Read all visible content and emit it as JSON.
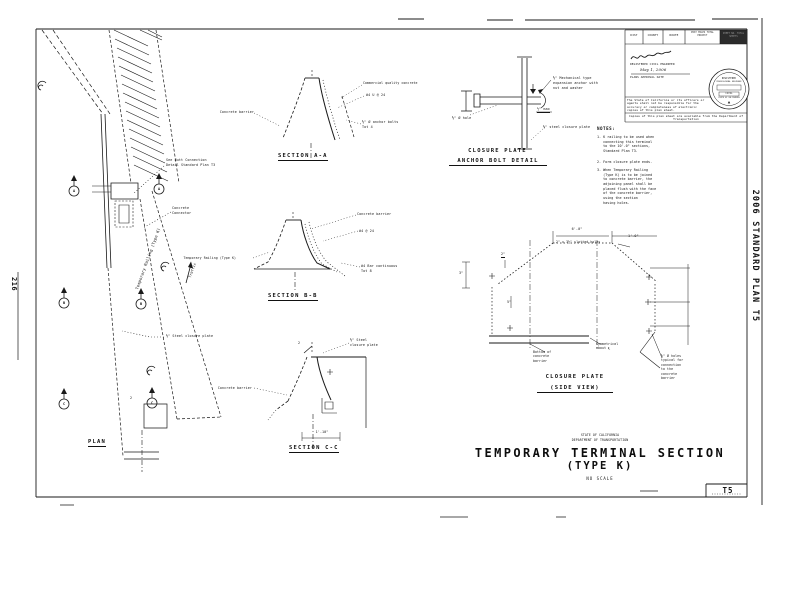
{
  "page": {
    "number": "216",
    "edge": "2006 STANDARD PLAN T5"
  },
  "titleblock": {
    "cols": [
      "DIST",
      "COUNTY",
      "ROUTE",
      "POST MILES TOTAL PROJECT",
      "SHEET NO. TOTAL SHEETS"
    ],
    "registered": "REGISTERED CIVIL ENGINEER",
    "date": "May 1, 2006",
    "approval": "PLANS APPROVAL DATE",
    "disclaimer": "The State of California or its officers or agents shall not be responsible for the accuracy or completeness of electronic copies of this plan sheet.",
    "strip": "Copies of this plan sheet are available from the Department of Transportation",
    "seal": {
      "l1": "REGISTERED",
      "l2": "PROFESSIONAL ENGINEER",
      "l3": "CIVIL",
      "l4": "STATE OF CALIFORNIA"
    }
  },
  "plan": {
    "title": "PLAN",
    "butt_connection": "See Butt Connection\nDetail Standard Plan T3",
    "connector": "Concrete\nConnector",
    "closure_plate": "⅜\" Steel closure plate",
    "railing": "Temporary Railing (Type K)",
    "traffic": "Traffic",
    "dim": "2",
    "cut_a": "A",
    "cut_b": "B",
    "cut_c": "C"
  },
  "section_a": {
    "title": "SECTION A-A",
    "barrier": "Concrete barrier",
    "concrete": "Commercial quality concrete",
    "bars": "#4 U @ 24",
    "anchors": "⅝\" Ø anchor bolts\nTot 4"
  },
  "section_b": {
    "title": "SECTION B-B",
    "railing": "Temporary Railing (Type K)",
    "barrier": "Concrete barrier",
    "bars": "#4 @ 24",
    "cont": "#4 Bar continuous\nTot 8"
  },
  "section_c": {
    "title": "SECTION C-C",
    "plate": "⅜\" Steel\nclosure plate",
    "barrier": "Concrete barrier",
    "dim": "1'-10\"",
    "bevel": "2"
  },
  "anchor_detail": {
    "title1": "CLOSURE PLATE",
    "title2": "ANCHOR BOLT DETAIL",
    "anchor": "⅝\" Mechanical type\nexpansion anchor with\nnut and washer",
    "max": "½\" max",
    "hole": "⅝\" Ø hole",
    "plate": "⅜\" steel closure plate"
  },
  "notes": {
    "heading": "NOTES:",
    "i1": "1. K railing to be used when\n   connecting this terminal\n   to the 10'-0\" sections,\n   Standard Plan T3.",
    "i2": "2. Form closure plate ends.",
    "i3": "3. When Temporary Railing\n   (Type K) is to be joined\n   to concrete barrier, the\n   adjoining panel shall be\n   placed flush with the face\n   of the concrete barrier,\n   using the section\n   having holes."
  },
  "side_view": {
    "title1": "CLOSURE PLATE",
    "title2": "(SIDE VIEW)",
    "dim_top": "6'-0\"",
    "dim_right": "1'-0\"",
    "dim_2": "2\"",
    "dim_5": "5\"",
    "dim_3": "3\"",
    "slots": "2\" x 3½\" slotted holes",
    "bottom": "Bottom of\nconcrete\nbarrier",
    "symm": "Symmetrical\nabout ℄",
    "holes": "⅝\" Ø holes\ntypical for\nconnection\nto the\nconcrete\nbarrier"
  },
  "footer": {
    "state": "STATE OF CALIFORNIA",
    "dept": "DEPARTMENT OF TRANSPORTATION",
    "title": "TEMPORARY TERMINAL SECTION",
    "subtitle": "(TYPE K)",
    "scale": "NO SCALE",
    "sheet": "T5"
  }
}
